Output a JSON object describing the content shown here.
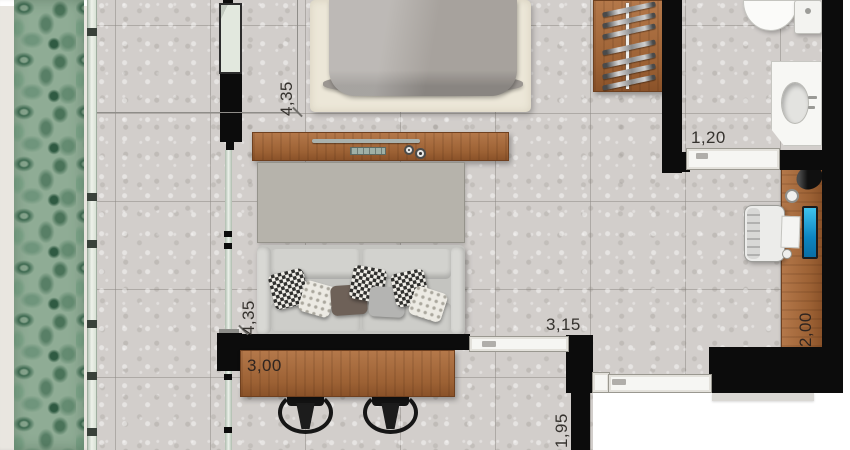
{
  "plan": {
    "type": "apartment-floor-plan",
    "dimensions": [
      {
        "id": "bedroom-depth",
        "label": "4,35",
        "orientation": "vertical"
      },
      {
        "id": "bathroom-door-width",
        "label": "1,20",
        "orientation": "horizontal"
      },
      {
        "id": "living-depth",
        "label": "4,35",
        "orientation": "vertical"
      },
      {
        "id": "entry-span",
        "label": "3,15",
        "orientation": "horizontal"
      },
      {
        "id": "counter-length",
        "label": "3,00",
        "orientation": "horizontal"
      },
      {
        "id": "desk-length",
        "label": "2,00",
        "orientation": "vertical"
      },
      {
        "id": "entry-depth",
        "label": "1,95",
        "orientation": "vertical"
      }
    ],
    "colors": {
      "wall": "#0c0c0c",
      "wood": "#9c6134",
      "tile": "#d2cecb",
      "garden": "#8fac95",
      "screen_accent": "#1fa7d8"
    },
    "furniture": [
      "bed",
      "media-console",
      "tv",
      "rug",
      "sofa",
      "pillows",
      "kitchen-counter",
      "bar-stools",
      "closet-hangers",
      "toilet",
      "sink",
      "sliding-doors",
      "desk",
      "desk-chair",
      "laptop"
    ]
  }
}
